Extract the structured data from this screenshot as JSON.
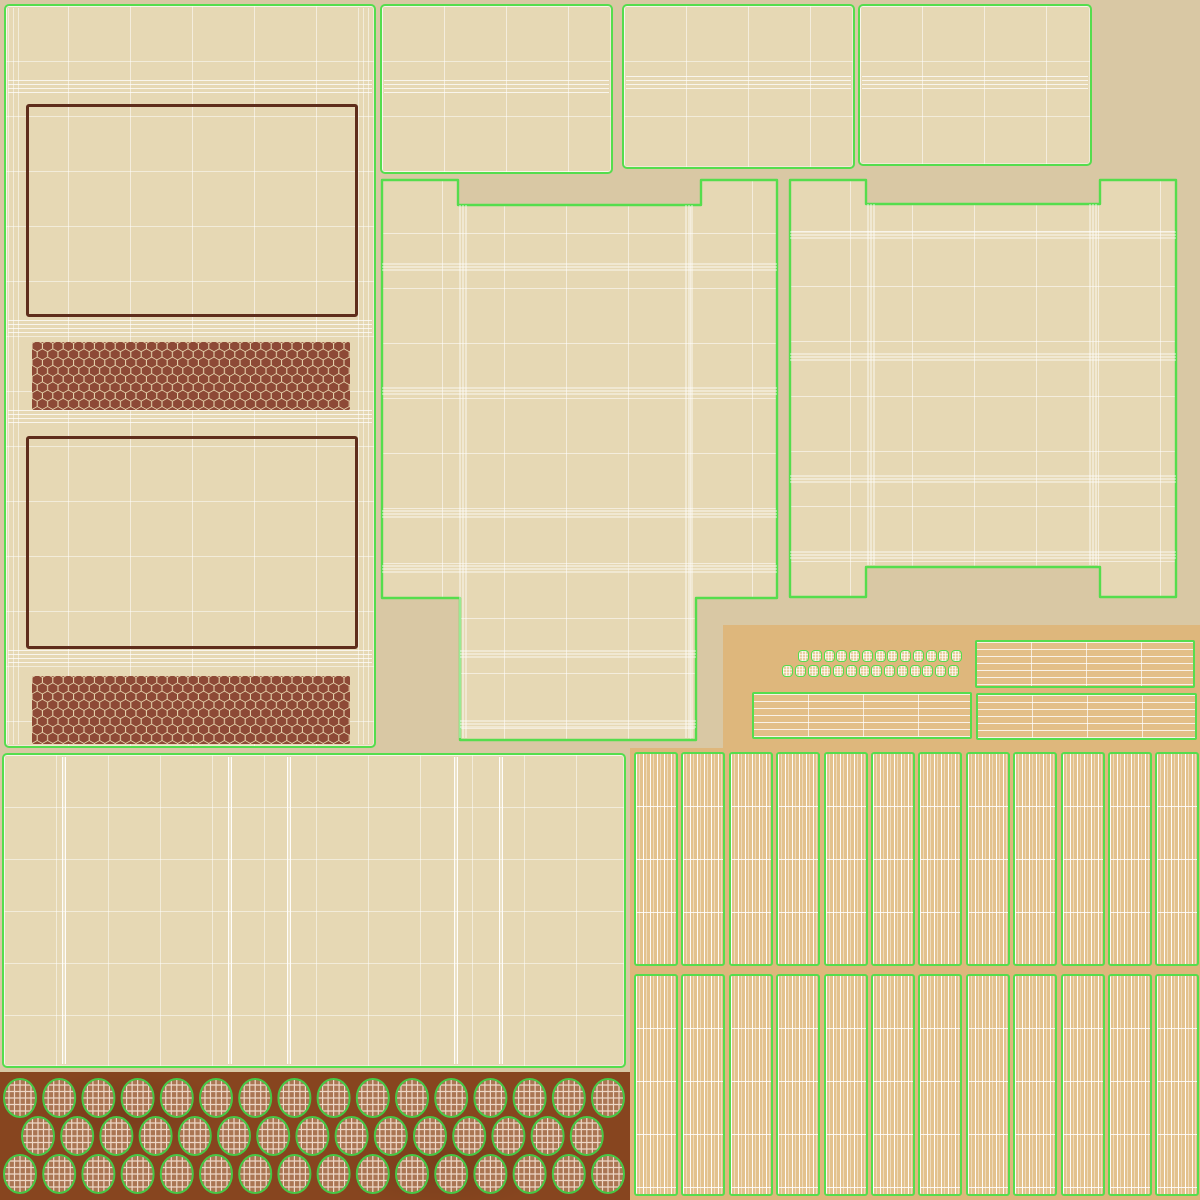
{
  "meta": {
    "description": "UV texture atlas (wireframe overlay) for a matchbox 3D model; no visible text anywhere in the image",
    "image_type": "uv-texture-atlas",
    "canvas": {
      "width": 1200,
      "height": 1200
    }
  },
  "palette": {
    "bg": "#d9c8a4",
    "panel": "#e6d8b4",
    "seam": "#55dd4d",
    "label-border": "#5f2d1b",
    "striker-bg": "#ecdcb4",
    "striker-hex": "#8d4936",
    "kraft": "#deb77c",
    "kraft-light": "#e3bf88",
    "stick": "#e3c28d",
    "head-strip": "#87451f",
    "head-fill": "#aa7553",
    "head-outline": "#46c845",
    "cap-fill": "#e9cfa0"
  },
  "islands": [
    {
      "name": "outer-wrap-panel",
      "desc": "tall left panel with two dark label frames and two honeycomb striker strips"
    },
    {
      "name": "top-flap-1",
      "desc": "small lid flap uv rectangle with middle fold band"
    },
    {
      "name": "top-flap-2",
      "desc": "small lid flap uv rectangle with middle fold band"
    },
    {
      "name": "top-flap-3",
      "desc": "small lid flap uv rectangle with middle fold band"
    },
    {
      "name": "tray-unwrap-left",
      "desc": "cross-shaped unfolded tray with top corner tabs and bottom extension"
    },
    {
      "name": "tray-unwrap-right",
      "desc": "unfolded tray with four corner tabs"
    },
    {
      "name": "kraft-card-sheet",
      "desc": "darker kraft cardboard region holding small parts"
    },
    {
      "name": "tray-side-strip-1",
      "desc": "thin striped tray side uv"
    },
    {
      "name": "tray-side-strip-2",
      "desc": "thin striped tray side uv"
    },
    {
      "name": "tray-side-strip-3",
      "desc": "thin striped tray side uv"
    },
    {
      "name": "match-cap-squares",
      "desc": "two rows of tiny rounded squares (match stick end caps)"
    },
    {
      "name": "matchstick-sheet",
      "desc": "two rows of twelve striped matchstick columns"
    },
    {
      "name": "bottom-sheet-panel",
      "desc": "wide beige wireframe panel above the match-head strip"
    },
    {
      "name": "match-head-strip",
      "desc": "dark sienna strip with three rows of wireframe match heads"
    }
  ],
  "matchsticks": {
    "columns": 12,
    "x0": 4,
    "pitch": 47.4,
    "width": 44,
    "segments_per_column": 4,
    "rows": [
      {
        "top": 4,
        "height": 214
      },
      {
        "top": 226,
        "height": 222
      }
    ]
  },
  "caps": {
    "size": {
      "w": 11,
      "h": 12
    },
    "pitch": 12.75,
    "rows": [
      {
        "count": 13,
        "x0": 23,
        "y": 2
      },
      {
        "count": 14,
        "x0": 7,
        "y": 17
      }
    ]
  },
  "match_heads": {
    "pitch": 39.2,
    "w": 36,
    "h": 40,
    "rows": [
      {
        "count": 16,
        "x0": 2,
        "y": 6,
        "flip": false
      },
      {
        "count": 15,
        "x0": 20,
        "y": 44,
        "flip": true
      },
      {
        "count": 16,
        "x0": 2,
        "y": 82,
        "flip": false
      }
    ]
  },
  "shape_folds": [
    {
      "id": "shape1",
      "bands_h": [
        {
          "x1": 2,
          "x2": 397,
          "y": 86
        },
        {
          "x1": 2,
          "x2": 397,
          "y": 210
        },
        {
          "x1": 2,
          "x2": 397,
          "y": 333
        },
        {
          "x1": 2,
          "x2": 397,
          "y": 388
        },
        {
          "x1": 80,
          "x2": 316,
          "y": 473
        },
        {
          "x1": 80,
          "x2": 316,
          "y": 543
        }
      ],
      "bands_v": [
        {
          "y1": 27,
          "y2": 560,
          "x": 80
        },
        {
          "y1": 27,
          "y2": 560,
          "x": 306
        }
      ]
    },
    {
      "id": "shape2",
      "bands_h": [
        {
          "x1": 2,
          "x2": 388,
          "y": 56
        },
        {
          "x1": 2,
          "x2": 388,
          "y": 178
        },
        {
          "x1": 2,
          "x2": 388,
          "y": 300
        },
        {
          "x1": 2,
          "x2": 388,
          "y": 376
        }
      ],
      "bands_v": [
        {
          "y1": 28,
          "y2": 389,
          "x": 80
        },
        {
          "y1": 28,
          "y2": 389,
          "x": 302
        }
      ]
    }
  ],
  "left_panel_folds": {
    "h_tops": [
      74,
      314,
      404,
      644
    ]
  },
  "bl_panel_bright_lines": [
    58,
    224,
    283,
    450,
    495
  ],
  "flap_fold_tops": {
    "a": 74,
    "b": 70,
    "c": 70
  }
}
